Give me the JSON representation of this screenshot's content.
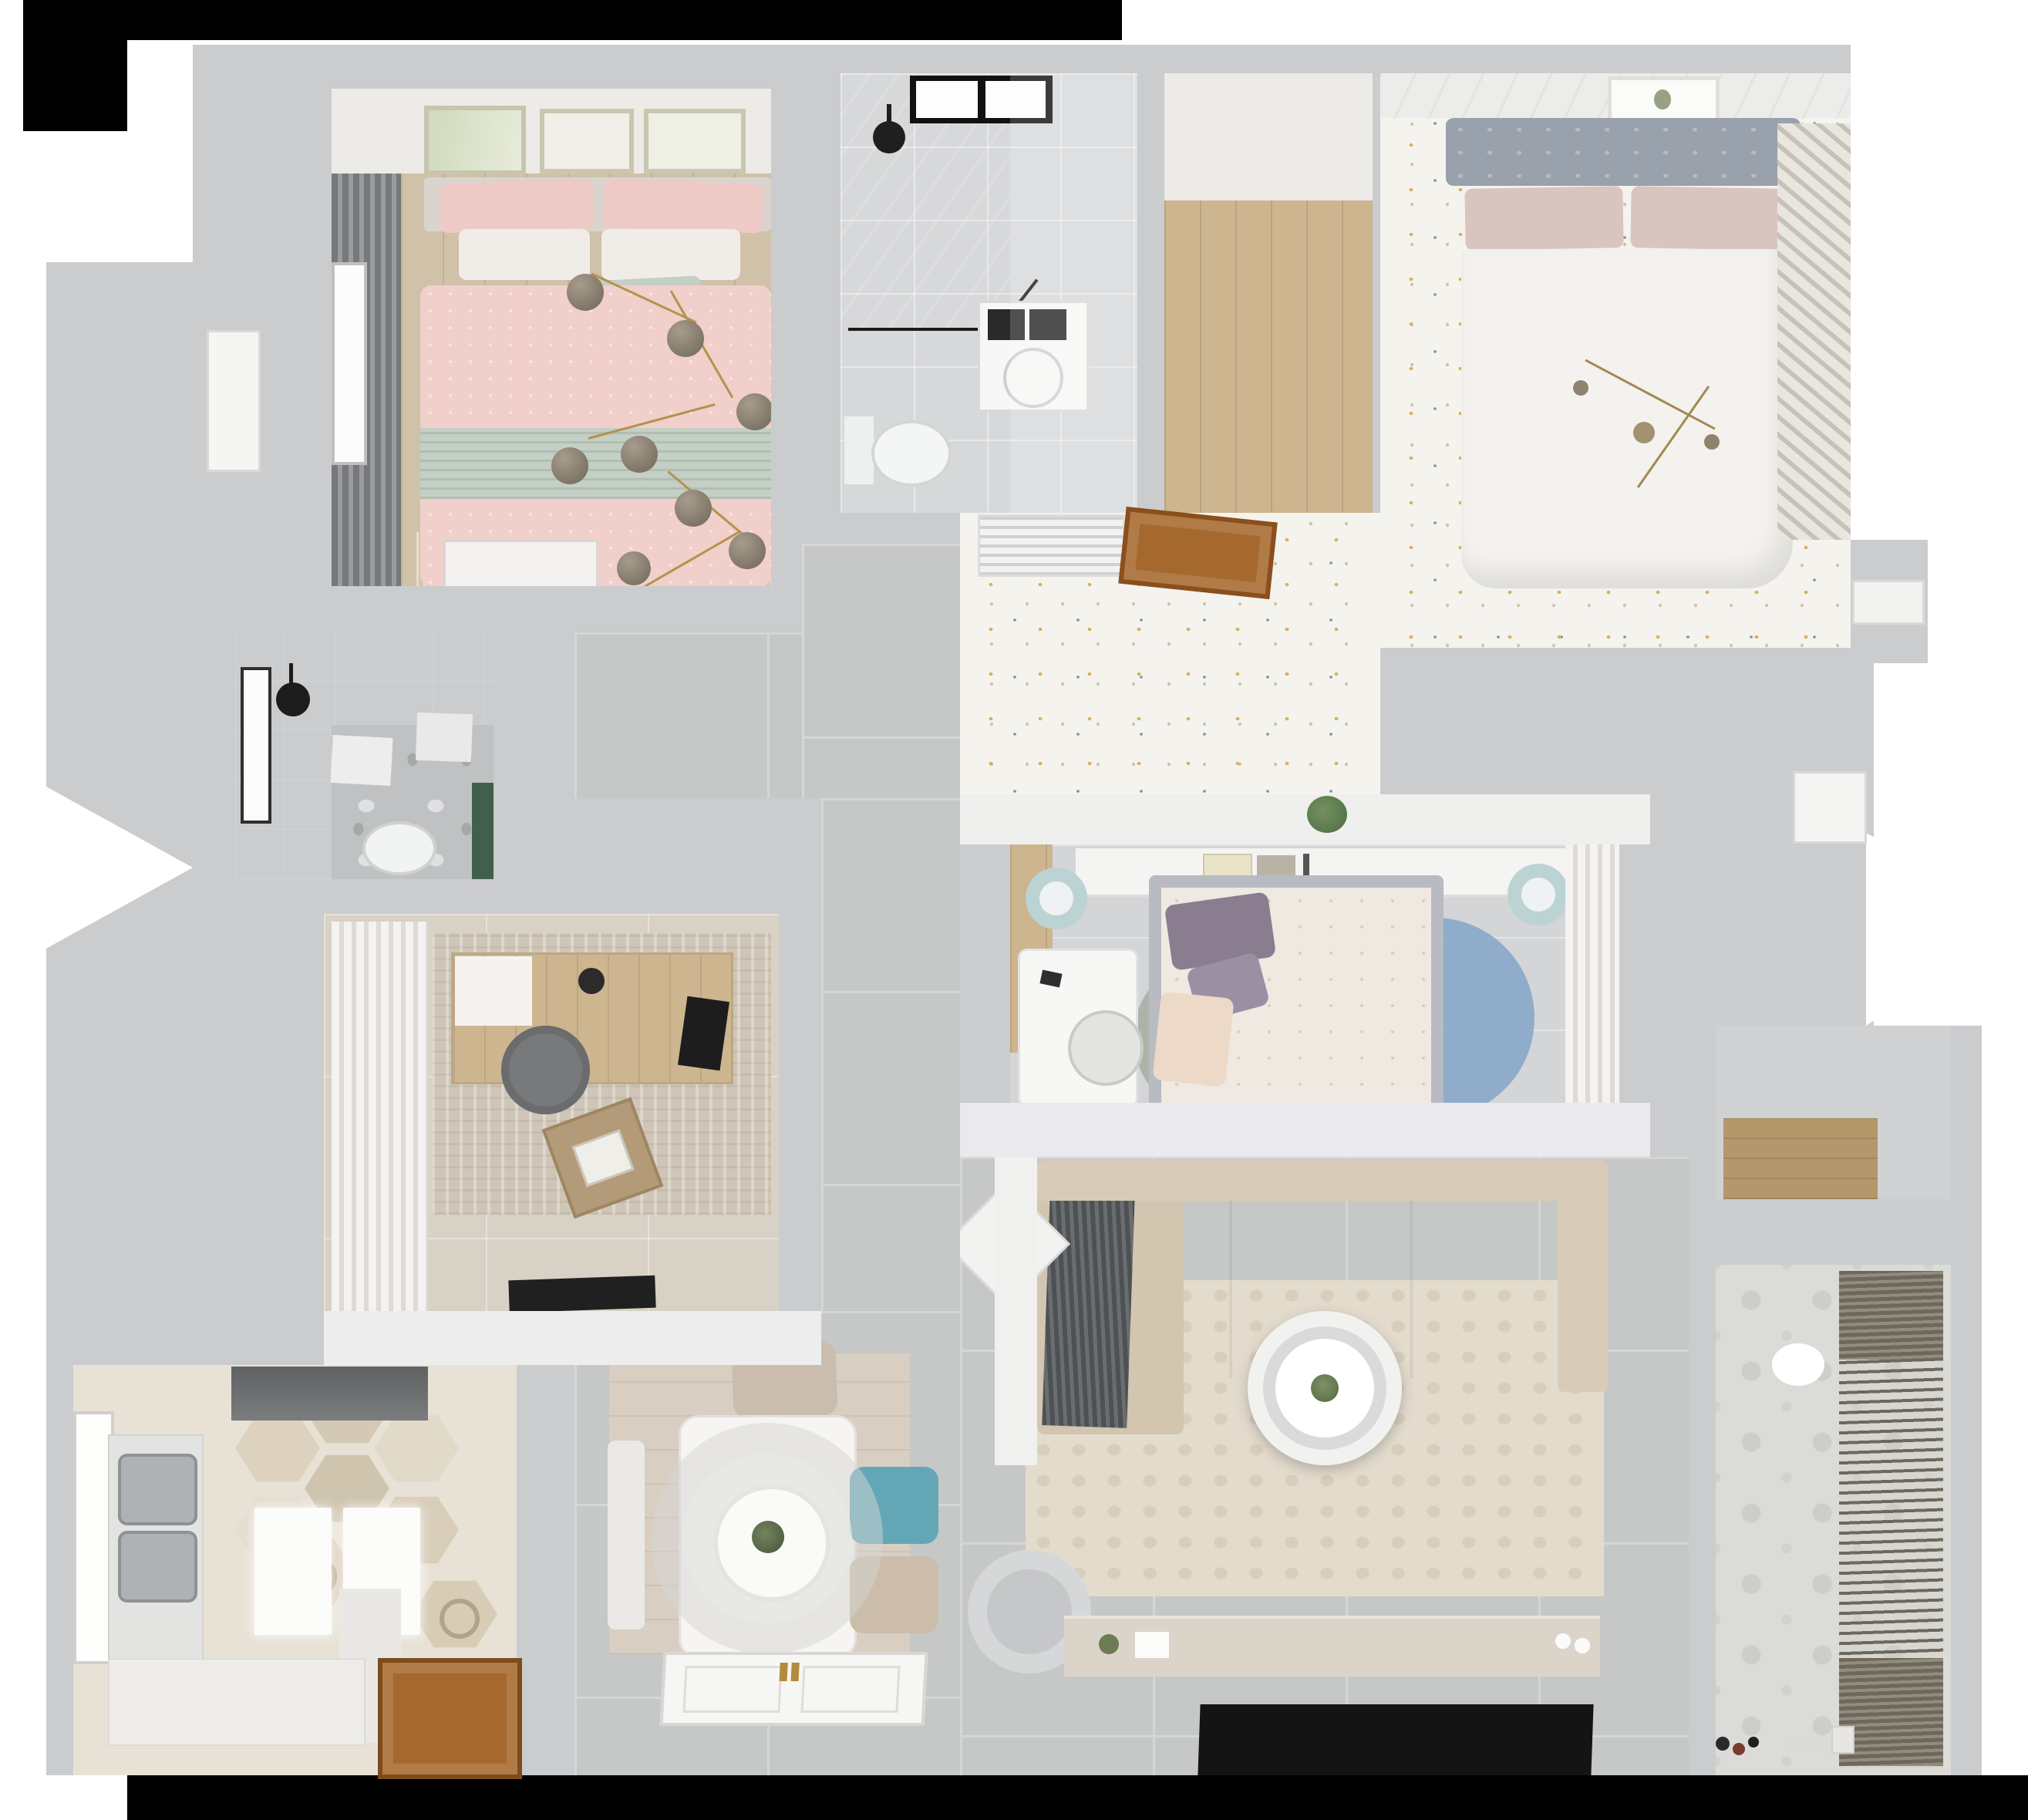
{
  "scene": {
    "type": "3d-floor-plan-top-view-render",
    "description": "Photorealistic bird's-eye render of a 3-bedroom apartment with two bathrooms, kitchen, dining area, living room and laundry balcony"
  },
  "palette": {
    "wall": "#cbccce",
    "wall_light": "#efefee",
    "tile": "#c6c7c7",
    "grout": "#d5d6d6",
    "warm_tile": "#d8d1c5",
    "wood": "#cfc2a9",
    "oak": "#cdb58f",
    "mat_wood": "#d8cfc2",
    "hex_base": "#e8e2d6",
    "door_wood": "#a5692e",
    "pink": "#f1cfca",
    "pink_pillow": "#eecac6",
    "sage": "#c4cfc5",
    "headboard_gray": "#99a1ac",
    "blush": "#d9c5bf",
    "dot_gold": "#d8b15e",
    "dot_blue": "#8298a5",
    "teal_stool": "#bcd3d4",
    "teal_chair": "#63a7b6",
    "purple_pillow": "#8b7d90",
    "rug_blue": "#82a6c8",
    "rug_mauve": "#967c7e",
    "rug_gray": "#a3aa9e",
    "sofa": "#cfc3ad",
    "sofa_back": "#d8ccb9",
    "throw": "#53565a",
    "cream_rug": "#e3dbcc",
    "console_wood": "#dbd4c8",
    "tv_black": "#141414",
    "dark_bath": "#6b6e70",
    "shower_dark": "#6e7173",
    "marble": "#d7d8da",
    "green_accent": "#40604b",
    "gold": "#b5924c",
    "blind": "#6d675c",
    "balcony_tile": "#dbdbd7"
  },
  "rooms": [
    {
      "name": "bedroom-1 pink double bed, gold branch chandelier, wall art, window curtains",
      "floor": "light wood"
    },
    {
      "name": "bathroom-1 with corner glass shower, washing machine, toilet, high window",
      "floor": "marble"
    },
    {
      "name": "walk-in closet hall",
      "floor": "oak planks"
    },
    {
      "name": "bedroom-2 white double bed, gray tufted headboard, louvered wardrobe",
      "floor": "dotted floral carpet"
    },
    {
      "name": "bedroom-2 vestibule with AC vent and open wooden door",
      "floor": "dotted floral carpet"
    },
    {
      "name": "bedroom-3 gray bed, white desk, headboard shelf, round rug of overlapping circles",
      "floor": "stone tile"
    },
    {
      "name": "living room with L-shaped sofa, round coffee table, TV console and wall TV",
      "floor": "gray tile"
    },
    {
      "name": "dining area with white table, pendant lamp, teal and beige chairs",
      "floor": "gray tile with wood mat"
    },
    {
      "name": "kitchen with hexagon tile, double sink, fridge, wooden door",
      "floor": "hex tile"
    },
    {
      "name": "bathroom-2 dark tiled with ceiling shower, toilet, window",
      "floor": "dark tile / marble"
    },
    {
      "name": "study with desk, round chair, sheer curtains, laptop pouf",
      "floor": "beige tile"
    },
    {
      "name": "balcony laundry with drying blinds, ball lamp, toys",
      "floor": "patterned tile"
    },
    {
      "name": "corridor and entry with paneled front door",
      "floor": "gray tile"
    },
    {
      "name": "utility niche with wooden shelf",
      "floor": "gray tile"
    }
  ],
  "furniture": {
    "bedroom1": [
      "double bed with pink patterned duvet",
      "sage green runner blanket",
      "pink and white pillows",
      "gray headboard",
      "three botanical art frames",
      "dark gray curtain with window",
      "gold branch chandelier with smoke glass globes",
      "white dresser",
      "fringed beige rug"
    ],
    "bathroom1": [
      "black framed corner shower",
      "black rain shower head",
      "high black-framed window",
      "white washing machine",
      "wall-hung toilet"
    ],
    "bedroom2": [
      "gray tufted headboard",
      "blush pillows",
      "white duvet",
      "gold sputnik chandelier",
      "framed plant sketch",
      "louvered wardrobe"
    ],
    "vestibule": [
      "white AC vent grille",
      "open wooden door leaf",
      "potted plant on half wall"
    ],
    "bedroom3": [
      "white headboard shelf with books",
      "two teal round stools",
      "white desk with chair",
      "gray upholstered bed",
      "purple and cream pillows",
      "floral duvet",
      "rug of blue, mauve and gray circles",
      "sheer-front wardrobe",
      "wood floor strip"
    ],
    "living": [
      "L-shaped beige sectional sofa",
      "dark gray throw blanket",
      "white diamond pouf",
      "gray round armchair",
      "two-tier round white coffee table with plant",
      "cream area rug",
      "light wood TV console with decor",
      "flat black TV panel",
      "partial partition wall"
    ],
    "dining": [
      "white rectangular dining table",
      "large layered pendant lamp with plant centerpiece",
      "beige chair",
      "teal chair",
      "second beige chair",
      "white bench",
      "wood-look dining mat",
      "white paneled entry door with brass handles"
    ],
    "kitchen": [
      "dark gray refrigerator",
      "double stainless sink counter",
      "white wall panels",
      "white base counters",
      "casement window",
      "brown wooden service door",
      "decorated hexagon tiles"
    ],
    "bathroom2": [
      "ceiling mounted black shower head",
      "white bath mat",
      "toilet",
      "green accent cabinet",
      "white towel",
      "casement window"
    ],
    "study": [
      "wood writing desk",
      "black laptop on desk",
      "gray round swivel chair",
      "sheer white curtains",
      "textured beige rug",
      "leather pouf with laptop",
      "black doormat"
    ],
    "balcony": [
      "roller drying blinds",
      "white sphere pendant lamp",
      "floor toys",
      "wooden shelf niche"
    ]
  }
}
